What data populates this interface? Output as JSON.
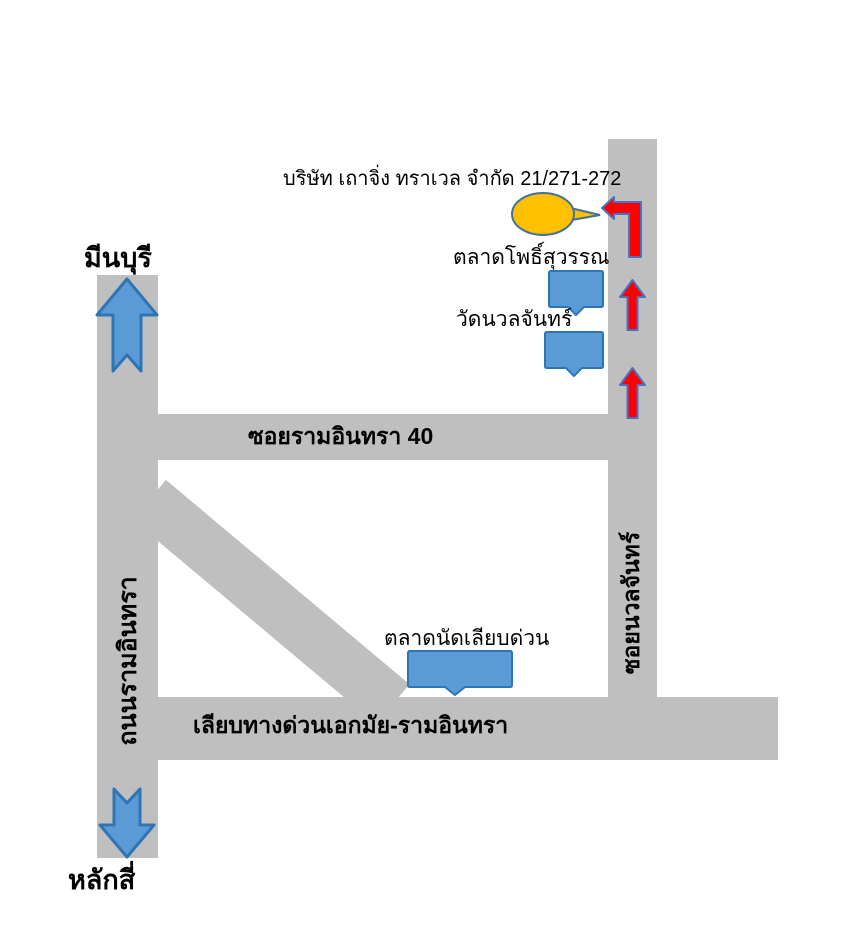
{
  "title": "บริษัท เถาจิ่ง ทราเวล จำกัด 21/271-272",
  "colors": {
    "road": "#BFBFBF",
    "marker_blue": "#5B9BD5",
    "marker_blue_border": "#2E75B6",
    "balloon_yellow": "#FFC000",
    "balloon_border": "#41719C",
    "arrow_red": "#FF0000",
    "arrow_red_border": "#4472C4",
    "text": "#000000"
  },
  "destination": {
    "label": "บริษัท เถาจิ่ง ทราเวล จำกัด 21/271-272",
    "marker": "yellow-balloon"
  },
  "roads": [
    {
      "id": "thanon-ramintra",
      "label": "ถนนรามอินทรา",
      "orientation": "vertical"
    },
    {
      "id": "soi-ramintra-40",
      "label": "ซอยรามอินทรา 40",
      "orientation": "horizontal"
    },
    {
      "id": "soi-nuanchan",
      "label": "ซอยนวลจันทร์",
      "orientation": "vertical"
    },
    {
      "id": "liap-expressway",
      "label": "เลียบทางด่วนเอกมัย-รามอินทรา",
      "orientation": "horizontal"
    },
    {
      "id": "diagonal-link-road",
      "label": "",
      "orientation": "diagonal"
    }
  ],
  "places": [
    {
      "id": "talat-pho-suwan",
      "label": "ตลาดโพธิ์สุวรรณ",
      "marker": "blue-bubble"
    },
    {
      "id": "wat-nuanchan",
      "label": "วัดนวลจันทร์",
      "marker": "blue-bubble"
    },
    {
      "id": "talat-nat-liap-duan",
      "label": "ตลาดนัดเลียบด่วน",
      "marker": "blue-bubble"
    }
  ],
  "endpoints": [
    {
      "id": "minburi",
      "label": "มีนบุรี",
      "direction": "up"
    },
    {
      "id": "laksi",
      "label": "หลักสี่",
      "direction": "down"
    }
  ],
  "route_arrows": {
    "color": "#FF0000",
    "count": 3,
    "directions": [
      "up",
      "up",
      "turn-left"
    ]
  }
}
